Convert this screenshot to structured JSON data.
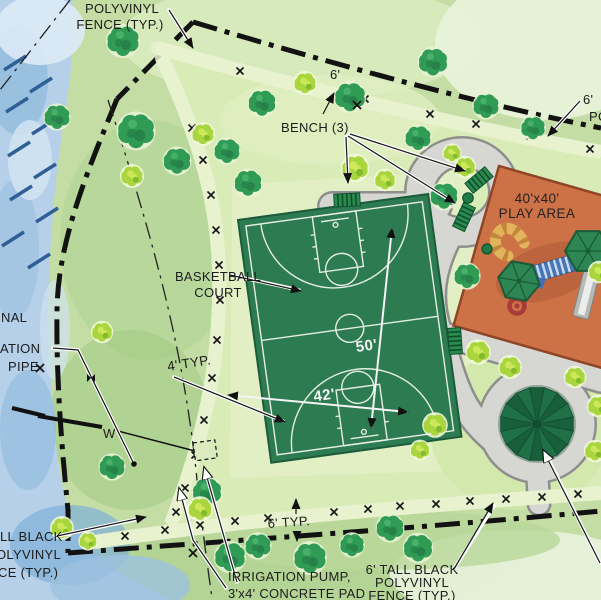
{
  "plan": {
    "title_hint": "park-site-plan",
    "labels": {
      "fence_top_left": {
        "line1": "POLYVINYL",
        "line2": "FENCE (TYP.)"
      },
      "fence_top_right": {
        "line1": "6'",
        "line2": "PO"
      },
      "fence_bottom_left": {
        "line1": "LL BLACK",
        "line2": "OLYVINYL",
        "line3": "CE (TYP.)"
      },
      "fence_bottom_right": {
        "line1": "6' TALL BLACK",
        "line2": "POLYVINYL",
        "line3": "FENCE (TYP.)"
      },
      "bench": "BENCH (3)",
      "basketball_court": {
        "line1": "BASKETBALL",
        "line2": "COURT"
      },
      "play_area": {
        "line1": "40'x40'",
        "line2": "PLAY AREA"
      },
      "irrigation_pump": {
        "line1": "IRRIGATION PUMP,",
        "line2": "3'x4' CONCRETE PAD"
      },
      "canal_partial": "NAL",
      "pipe_partial": {
        "line1": "ATION",
        "line2": "PIPE"
      },
      "water_line": "W"
    },
    "dimensions": {
      "court_length": "50'",
      "court_width": "42'",
      "hedge_offset_top": "6'",
      "hedge_offset_bottom": "6' TYP.",
      "court_buffer": "4' TYP."
    },
    "colors": {
      "court_green": "#2d7b51",
      "play_area_orange": "#cd7247",
      "path_gray": "#d6d7d3",
      "water_blue": "#aecbe5",
      "fence_black": "#121212",
      "lawn_light": "#d9ecb8",
      "grass_base": "#c3dda4",
      "gazebo_green": "#1f6f47"
    }
  }
}
